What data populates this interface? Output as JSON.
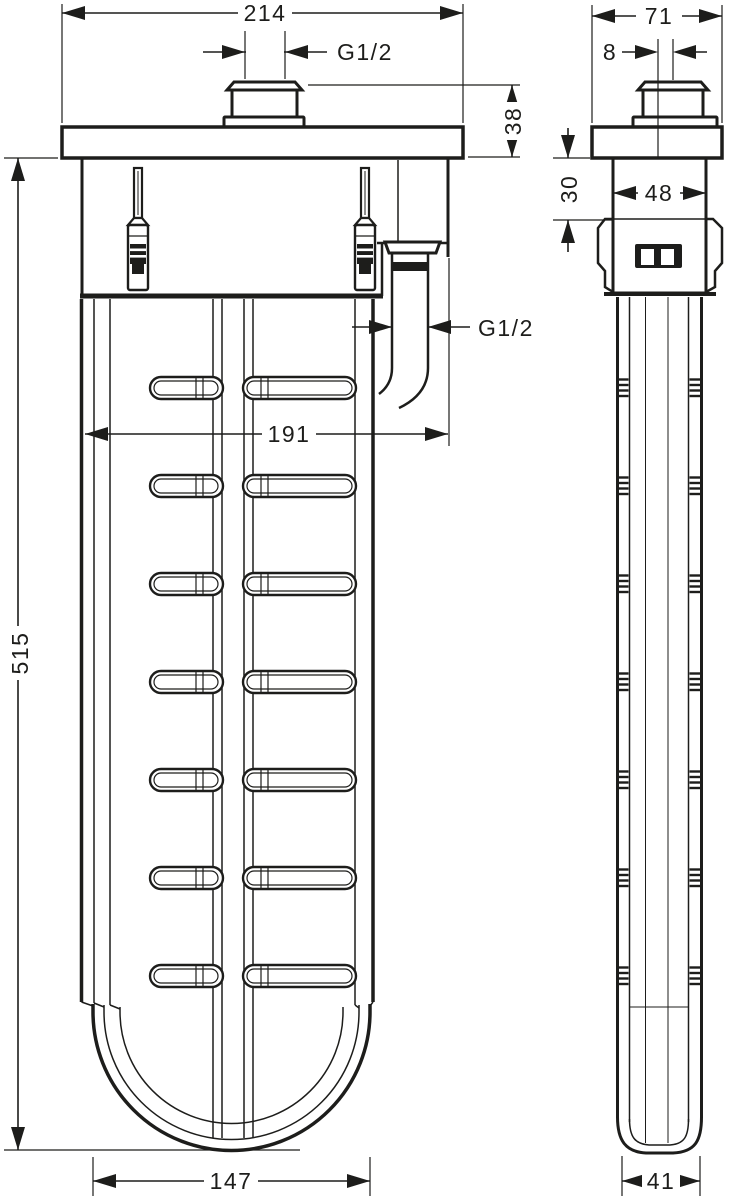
{
  "drawing": {
    "background": "#ffffff",
    "line_color": "#1d1d1b",
    "views": {
      "front_view": "fixture front elevation with flush-mount flange, top thread connector, fastening screws, side outlet and ribbed basket body",
      "side_view": "fixture side elevation with flange, thread connector, mounting clip and slim ribbed shaft"
    },
    "dimensions": {
      "front_overall_width": "214",
      "top_connection_thread": "G1/2",
      "flange_stack_height": "38",
      "outlet_connection_thread": "G1/2",
      "front_inner_width": "191",
      "overall_height": "515",
      "front_bottom_width": "147",
      "side_overall_width": "71",
      "connection_offset": "8",
      "side_body_width": "48",
      "clip_distance": "30",
      "side_bottom_width": "41"
    }
  }
}
